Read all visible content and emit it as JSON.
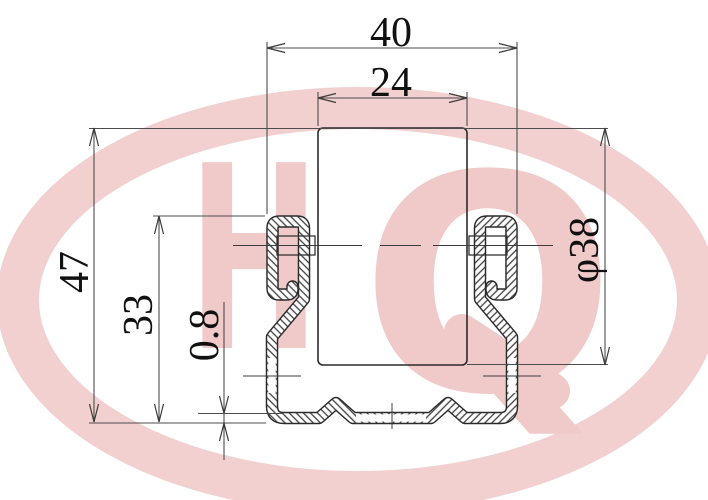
{
  "drawing": {
    "title": "channel-profile-cross-section",
    "dimensions": {
      "overall_width": "40",
      "opening_width": "24",
      "overall_height": "47",
      "hook_height": "33",
      "material_thickness": "0.8",
      "pipe_diameter": "φ38"
    },
    "watermark": {
      "letter_h": "H",
      "letter_q": "Q"
    },
    "colors": {
      "watermark_pink": "#f0c9c9",
      "outline_dark": "#2b2b2b",
      "dimension_line": "#4d4d4d",
      "hatch_line": "#3f3f3f",
      "background": "#ffffff"
    }
  }
}
